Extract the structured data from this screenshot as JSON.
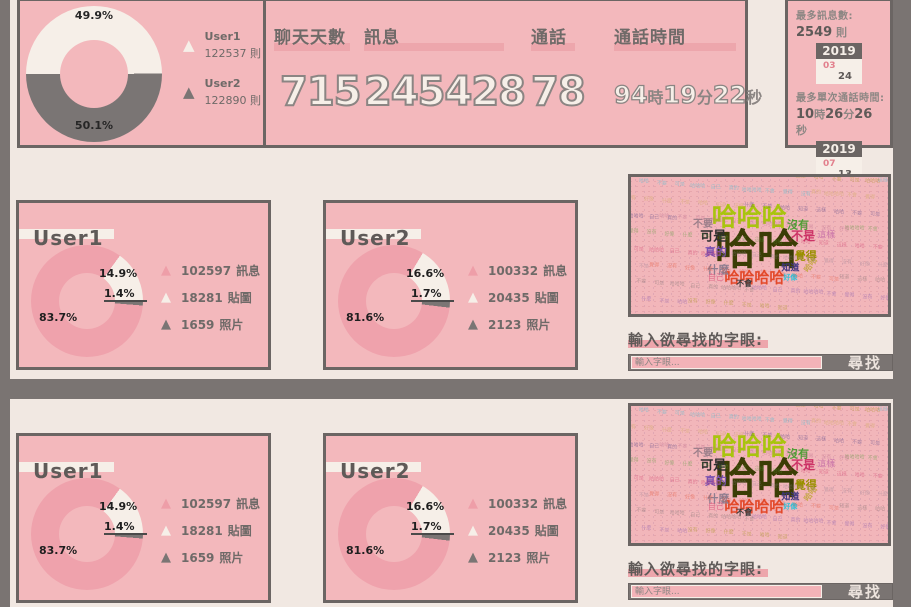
{
  "top": {
    "overall_donut": {
      "type": "pie",
      "start_deg": 270,
      "slices": [
        {
          "label": "User1",
          "value": 122537,
          "pct": 49.9,
          "pct_label": "49.9%",
          "color": "#f6efe8"
        },
        {
          "label": "User2",
          "value": 122890,
          "pct": 50.1,
          "pct_label": "50.1%",
          "color": "#7a7574"
        }
      ]
    },
    "legend": [
      {
        "name": "User1",
        "count": "122537 則"
      },
      {
        "name": "User2",
        "count": "122890 則"
      }
    ],
    "stats": [
      {
        "label": "聊天天數",
        "value": "715"
      },
      {
        "label": "訊息",
        "value": "245428"
      },
      {
        "label": "通話",
        "value": "78"
      },
      {
        "label": "通話時間",
        "value": "94時19分22秒"
      }
    ],
    "records": {
      "record1": {
        "label": "最多訊息數:",
        "value": "2549 則",
        "calendar": {
          "year": "2019",
          "month": "03",
          "day": "24"
        }
      },
      "record2": {
        "label": "最多單次通話時間:",
        "value": "10時26分26秒",
        "calendar": {
          "year": "2019",
          "month": "07",
          "day": "13"
        }
      }
    }
  },
  "cards": {
    "user1": {
      "title": "User1",
      "chart": {
        "type": "pie",
        "start_deg": 36,
        "slices": [
          {
            "label": "貼圖",
            "value": 18281,
            "pct": 14.9,
            "pct_label": "14.9%",
            "color": "#f6efe8"
          },
          {
            "label": "照片",
            "value": 1659,
            "pct": 1.4,
            "pct_label": "1.4%",
            "color": "#7a7574"
          },
          {
            "label": "訊息",
            "value": 102597,
            "pct": 83.7,
            "pct_label": "83.7%",
            "color": "#efa2ac"
          }
        ]
      },
      "legend": [
        {
          "count": "102597",
          "label": "訊息",
          "color": "#efa2ac"
        },
        {
          "count": "18281",
          "label": "貼圖",
          "color": "#f6efe8"
        },
        {
          "count": "1659",
          "label": "照片",
          "color": "#7a7574"
        }
      ]
    },
    "user2": {
      "title": "User2",
      "chart": {
        "type": "pie",
        "start_deg": 31,
        "slices": [
          {
            "label": "貼圖",
            "value": 20435,
            "pct": 16.6,
            "pct_label": "16.6%",
            "color": "#f6efe8"
          },
          {
            "label": "照片",
            "value": 2123,
            "pct": 1.7,
            "pct_label": "1.7%",
            "color": "#7a7574"
          },
          {
            "label": "訊息",
            "value": 100332,
            "pct": 81.6,
            "pct_label": "81.6%",
            "color": "#efa2ac"
          }
        ]
      },
      "legend": [
        {
          "count": "100332",
          "label": "訊息",
          "color": "#efa2ac"
        },
        {
          "count": "20435",
          "label": "貼圖",
          "color": "#f6efe8"
        },
        {
          "count": "2123",
          "label": "照片",
          "color": "#7a7574"
        }
      ]
    }
  },
  "wordcloud": {
    "words": [
      {
        "t": "哈哈",
        "x": 49,
        "y": 53,
        "s": 42,
        "c": "#3b3d05",
        "b": 1
      },
      {
        "t": "哈哈哈",
        "x": 46,
        "y": 29,
        "s": 25,
        "c": "#a9c40e",
        "b": 1
      },
      {
        "t": "哈哈哈哈",
        "x": 48,
        "y": 74,
        "s": 15,
        "c": "#e3492b",
        "b": 1
      },
      {
        "t": "沒有",
        "x": 65,
        "y": 35,
        "s": 11,
        "c": "#4f9e35",
        "b": 1
      },
      {
        "t": "不是",
        "x": 67,
        "y": 43,
        "s": 12,
        "c": "#cc3366",
        "b": 1
      },
      {
        "t": "這樣",
        "x": 76,
        "y": 43,
        "s": 9,
        "c": "#c973a8",
        "b": 0
      },
      {
        "t": "可是",
        "x": 32,
        "y": 44,
        "s": 13,
        "c": "#2e2e2e",
        "b": 1
      },
      {
        "t": "真的",
        "x": 33,
        "y": 55,
        "s": 11,
        "c": "#7b52b0",
        "b": 1
      },
      {
        "t": "覺得",
        "x": 68,
        "y": 58,
        "s": 11,
        "c": "#9a9000",
        "b": 1
      },
      {
        "t": "什麼",
        "x": 34,
        "y": 68,
        "s": 11,
        "c": "#8f7d8f",
        "b": 1
      },
      {
        "t": "知道",
        "x": 62,
        "y": 67,
        "s": 9,
        "c": "#3d3580",
        "b": 1
      },
      {
        "t": "不要",
        "x": 28,
        "y": 35,
        "s": 10,
        "c": "#9c7f8a",
        "b": 1
      },
      {
        "t": "自己",
        "x": 33,
        "y": 74,
        "s": 8,
        "c": "#e06a8a",
        "b": 0
      },
      {
        "t": "不會",
        "x": 44,
        "y": 78,
        "s": 8,
        "c": "#3a3a3a",
        "b": 1
      },
      {
        "t": "好像",
        "x": 62,
        "y": 74,
        "s": 7,
        "c": "#2fc0d8",
        "b": 1
      },
      {
        "t": "哈哈",
        "x": 70,
        "y": 64,
        "s": 8,
        "c": "#c8a84b",
        "b": 1,
        "r": -55
      }
    ]
  },
  "search": {
    "label": "輸入欲尋找的字眼:",
    "placeholder": "輸入字眼...",
    "button_label": "尋找"
  },
  "colors": {
    "canvas": "#7a7472",
    "page_bg": "#f1e8e2",
    "panel_pink": "#f3b8bc",
    "accent_bar_pink": "#eda6ac",
    "slice_pink": "#efa2ac",
    "slice_cream": "#f6efe8",
    "slice_gray": "#7a7574",
    "border_gray": "#6b6563",
    "text_gray": "#6f6a68",
    "calendar_month_pink": "#e2808d"
  }
}
